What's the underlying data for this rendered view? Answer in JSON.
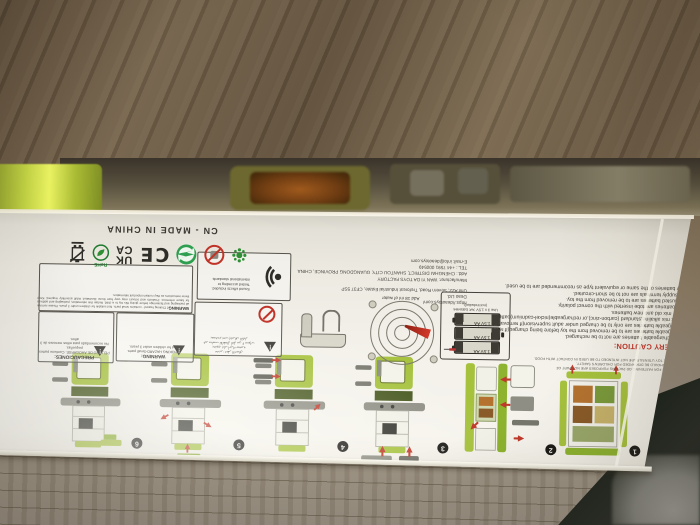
{
  "colors": {
    "toy_green": "#a6c23d",
    "toy_dark_green": "#47581f",
    "warning_red": "#c03328",
    "panel_white": "#f3f1ea",
    "floor_brown": "#6f5e49",
    "floor_grey": "#968b7b"
  },
  "panel": {
    "made_in": "CN - MADE IN CHINA",
    "steps": [
      "1",
      "2",
      "3",
      "4",
      "5",
      "6"
    ],
    "fine_print_lines": [
      "ALL MATERIALS FOR FASTENING OR PACKING PURPOSES ARE NOT PART OF",
      "THE TOY AND SHOULD BE DISCARDED FOR CHILDREN'S SAFETY.",
      "WARNING: THE TOY UTENSILS ARE NOT INTENDED TO BE USED IN CONTACT WITH FOOD."
    ],
    "battery_caution": {
      "title": "BATTERY CAUTION:",
      "items": [
        "1.Non-rechargeable batteries are not to be recharged.",
        "2.rechargeable batteries are to be removed from the toy before being charged(if removable).",
        "3.rechargeable batteries are only to be charged under adult supervision(if removable).",
        "4.do not mix alkaline,standard (carbon-zinc),or rechargeable(nickel-cadmium)batteries.",
        "5.never mix old and new batteries.",
        "6.only batteries are tobe inserted with the correct polarity.",
        "7.exhausted batteries are to be removed from the toy.",
        "8.the supply terminals are not to be short-circuited.",
        "9.only batteries of the same or equivalent type as recommended are to be used."
      ]
    },
    "manufacturer": {
      "line1": "https://deaotoys.com/",
      "line2": "Deao Ltd.",
      "line3": "Unit A22, Severn Road, Treforest Industrial Estate, CF37 5SP",
      "line4": "Manufacturer: WAN YI DA TOYS FACTORY",
      "line5": "Add.: CHENGHAI DISTRICT, SHANTOU CITY, GUANGDONG PROVINCE, CHINA",
      "line6": "TEL.: +44 7591 000549",
      "line7": "E-mail: info@deaotoys.com"
    },
    "battery_box": {
      "caption_line1": "Use 3 x 1.5V 'AA' batteries",
      "caption_line2": "(not included)",
      "cell_label": "1.5V AA"
    },
    "water_note": "Add 18 ml of water",
    "sound_box": {
      "line1": "Sound effects included.",
      "line2": "Tested according to international standards"
    },
    "warning_main": {
      "title": "WARNING:",
      "body": "Choking hazard - contains small parts. Not suitable for children under 3 years. Please remove all packaging and fastenings before giving this toy to a child. Retain this information, packaging and address for future reference. Products and colours may vary from those illustrated. Adult assembly required. Keep these instructions as they contain important information."
    },
    "choking": {
      "title": "WARNING:",
      "line1": "CHOKING HAZARD-Small parts.",
      "line2": "Not for children under 3 years."
    },
    "precauciones": {
      "title": "PRECAUCIONES:",
      "line1": "PELIGRO DE AHOGARSE. Contiene partes pequeñas.",
      "line2": "No recomendado para niños menores de 3 años."
    },
    "arabic_box": {
      "line1": "تحذير: خطر الاختناق",
      "line2": "يحتوي على أجزاء صغيرة",
      "line3": "غير مناسب للأطفال أقل من ٣ سنوات",
      "line4": "يستخدم تحت إشراف الكبار"
    },
    "symbols": {
      "ukca_top": "UK",
      "ukca_bottom": "CA",
      "ce": "CE",
      "rohs": "RoHS"
    }
  }
}
